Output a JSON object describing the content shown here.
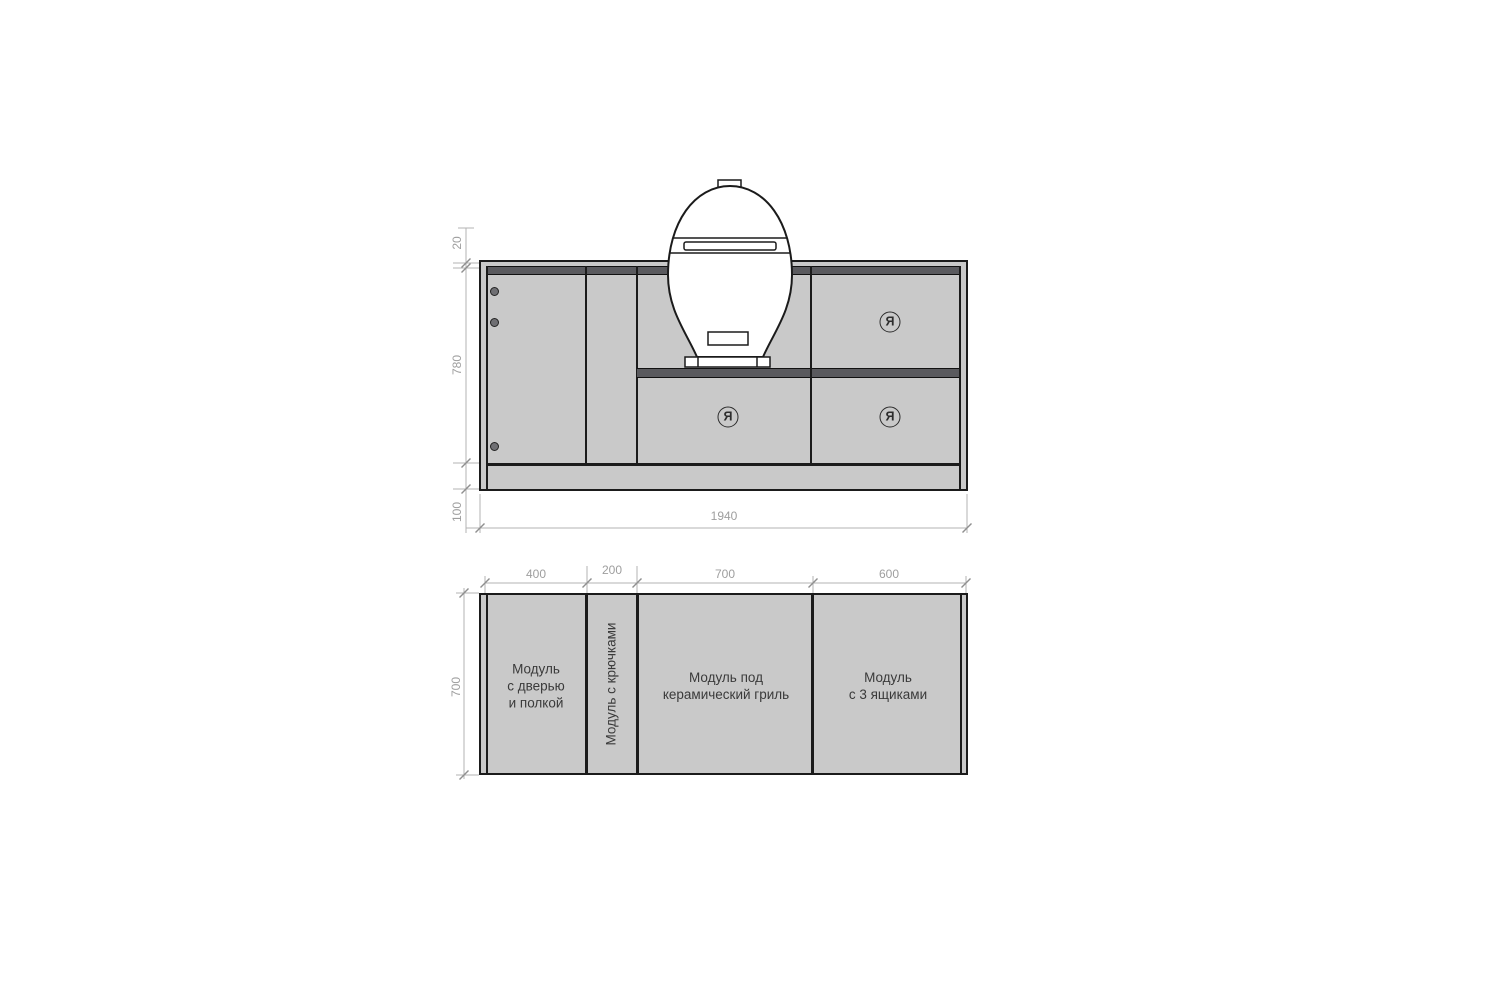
{
  "drawing": {
    "brand_letter": "Я",
    "colors": {
      "cabinet_fill": "#c9c9c9",
      "recess_dark": "#5a5a5e",
      "outline": "#1b1b1b",
      "dimension_gray": "#9e9e9e",
      "label_dark": "#3a3a3a"
    }
  },
  "elevation": {
    "dim_countertop": "20",
    "dim_body_height": "780",
    "dim_plinth": "100",
    "dim_total_width": "1940"
  },
  "plan": {
    "dim_module_widths": [
      "400",
      "200",
      "700",
      "600"
    ],
    "dim_depth": "700",
    "modules": [
      {
        "lines": [
          "Модуль",
          "с дверью",
          "и полкой"
        ]
      },
      {
        "label": "Модуль с крючками"
      },
      {
        "lines": [
          "Модуль под",
          "керамический гриль"
        ]
      },
      {
        "lines": [
          "Модуль",
          "с 3 ящиками"
        ]
      }
    ]
  }
}
